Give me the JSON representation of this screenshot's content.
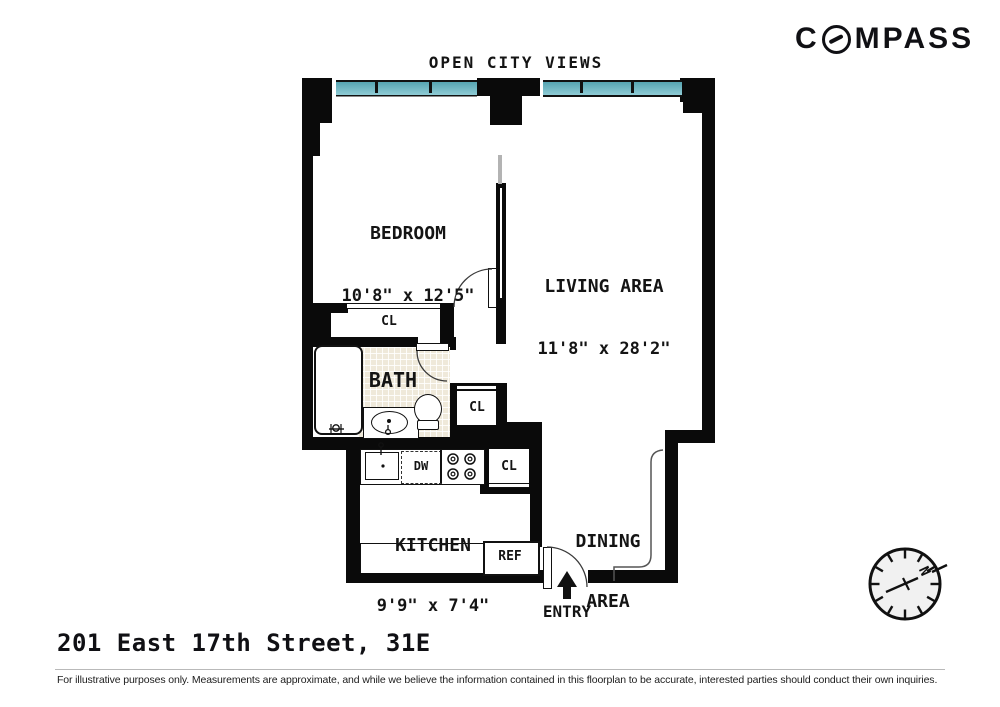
{
  "brand": {
    "logo_text": "COMPASS",
    "logo_prefix": "C",
    "logo_suffix": "MPASS"
  },
  "header": {
    "view_label": "OPEN CITY VIEWS"
  },
  "rooms": {
    "bedroom": {
      "name": "BEDROOM",
      "dims": "10'8\" x 12'5\""
    },
    "living": {
      "name": "LIVING AREA",
      "dims": "11'8\" x 28'2\""
    },
    "kitchen": {
      "name": "KITCHEN",
      "dims": "9'9\" x 7'4\""
    },
    "dining": {
      "line1": "DINING",
      "line2": "AREA"
    },
    "bath": {
      "name": "BATH"
    }
  },
  "closets": {
    "bedroom_closet": "CL",
    "hall_closet": "CL",
    "kitchen_closet": "CL"
  },
  "appliances": {
    "dishwasher": "DW",
    "refrigerator": "REF"
  },
  "entry": {
    "label": "ENTRY"
  },
  "compass_rose": {
    "north_label": "N"
  },
  "footer": {
    "address": "201 East 17th Street, 31E",
    "disclaimer": "For illustrative purposes only.  Measurements are approximate, and while we believe the information contained in this floorplan to be accurate, interested parties should conduct their own inquiries."
  },
  "colors": {
    "wall": "#0a0a0a",
    "window": "#74bcc6",
    "tile": "#efe9da"
  }
}
